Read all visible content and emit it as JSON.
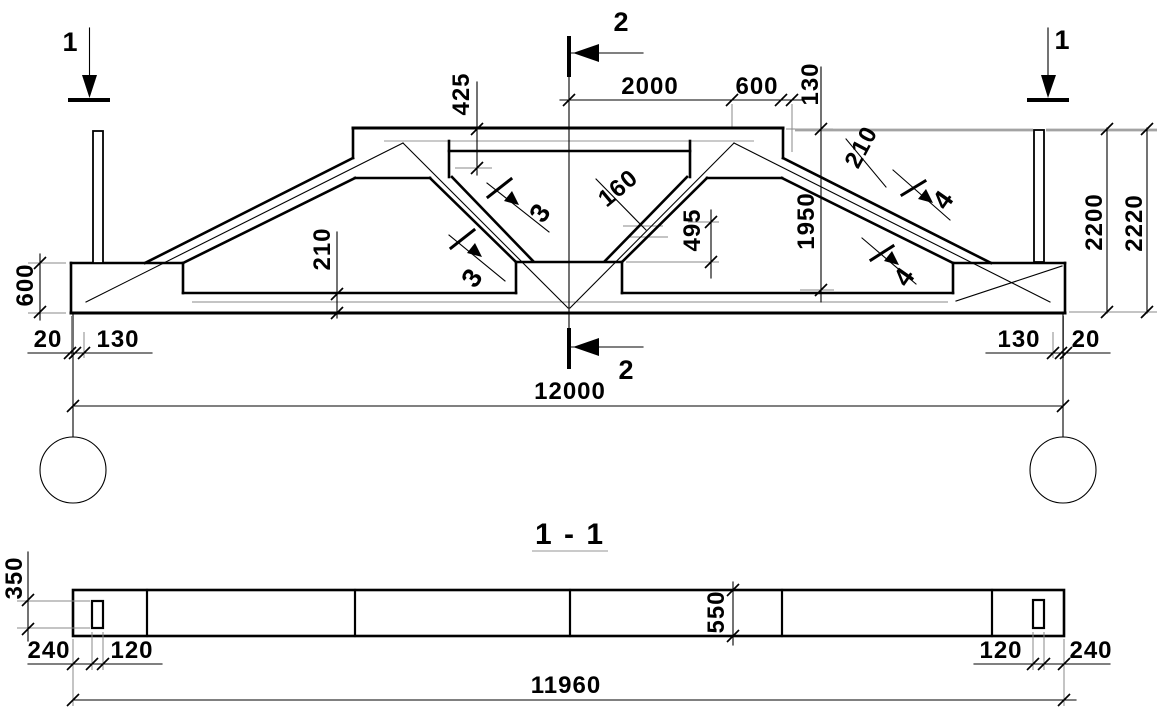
{
  "canvas": {
    "background": "#ffffff",
    "line_color": "#000000",
    "extension_line_color": "#8a8a8a"
  },
  "elevation": {
    "section_marker_1_left": "1",
    "section_marker_1_right": "1",
    "section_marker_2_top": "2",
    "section_marker_2_bottom": "2",
    "section_marker_3_upper": "3",
    "section_marker_3_lower": "3",
    "section_marker_4_upper": "4",
    "section_marker_4_lower": "4",
    "dim_top_center": "2000",
    "dim_top_600": "600",
    "dim_top_130": "130",
    "dim_425": "425",
    "dim_web_160": "160",
    "dim_web_495": "495",
    "dim_1950": "1950",
    "dim_chord_210": "210",
    "dim_bottom_chord_210": "210",
    "dim_height_2200": "2200",
    "dim_height_2220": "2220",
    "dim_end_600": "600",
    "dim_left_20": "20",
    "dim_left_130": "130",
    "dim_right_130": "130",
    "dim_right_20": "20",
    "dim_span_12000": "12000"
  },
  "section_view": {
    "title": "1 - 1",
    "dim_hole_350": "350",
    "dim_depth_550": "550",
    "dim_left_240": "240",
    "dim_left_120": "120",
    "dim_right_120": "120",
    "dim_right_240": "240",
    "dim_length_11960": "11960"
  }
}
